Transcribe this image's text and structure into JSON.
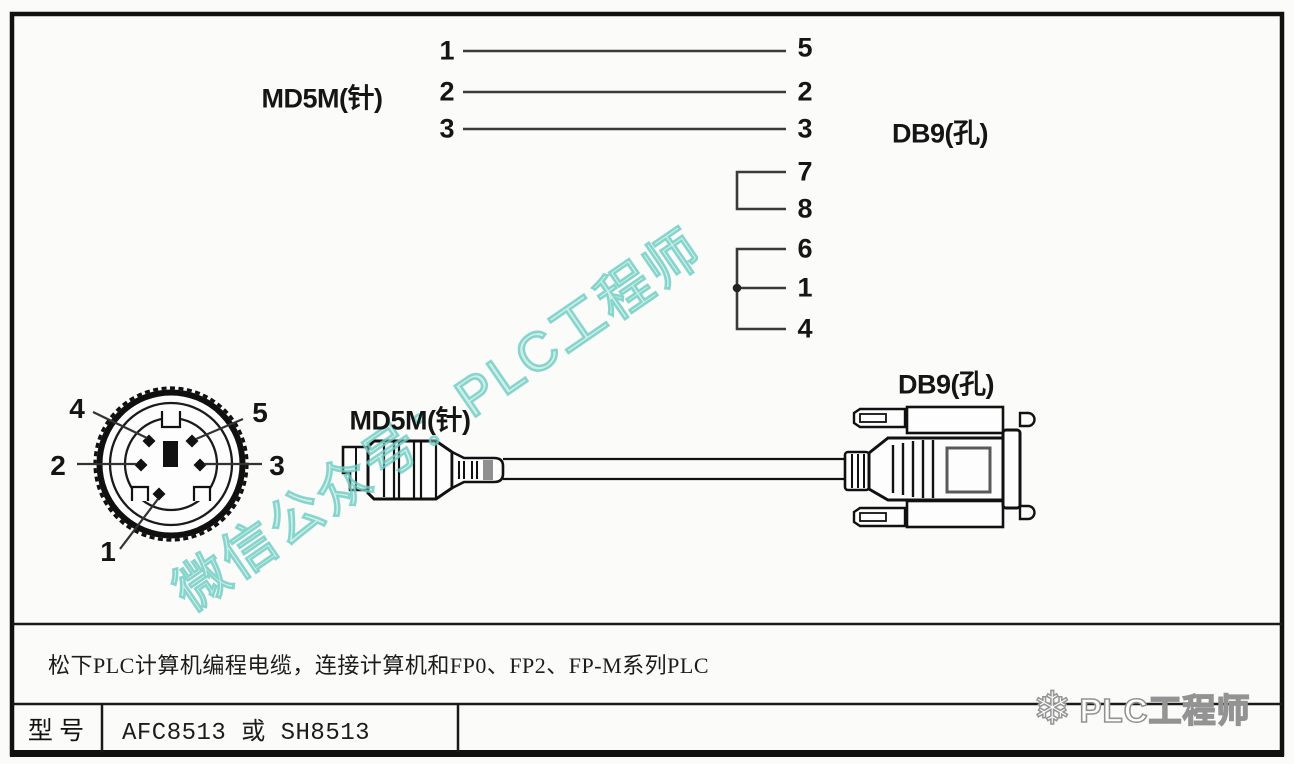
{
  "schematic": {
    "md5m_label": "MD5M(针)",
    "db9_label": "DB9(孔)",
    "wires": [
      {
        "md5m_pin": "1",
        "db9_pin": "5"
      },
      {
        "md5m_pin": "2",
        "db9_pin": "2"
      },
      {
        "md5m_pin": "3",
        "db9_pin": "3"
      }
    ],
    "db9_jumpers": [
      {
        "pins": [
          "7",
          "8"
        ]
      },
      {
        "pins": [
          "6",
          "1",
          "4"
        ]
      }
    ]
  },
  "din_face": {
    "pin_labels": {
      "upper_left": "4",
      "upper_right": "5",
      "left": "2",
      "right": "3",
      "bottom": "1"
    }
  },
  "cable_view": {
    "md5m_label": "MD5M(针)",
    "db9_label": "DB9(孔)"
  },
  "footer": {
    "description": "松下PLC计算机编程电缆，连接计算机和FP0、FP2、FP-M系列PLC",
    "model_label": "型 号",
    "model_value": "AFC8513 或 SH8513"
  },
  "watermark": {
    "text": "微信公众号：PLC工程师",
    "color": "#8bd9d0"
  },
  "brand": {
    "icon": "snowflake-icon",
    "glyph": "❄",
    "text": "PLC工程师",
    "outline_color": "#939393"
  },
  "colors": {
    "ink": "#1a1a1a",
    "paper": "#fbfbfa"
  }
}
